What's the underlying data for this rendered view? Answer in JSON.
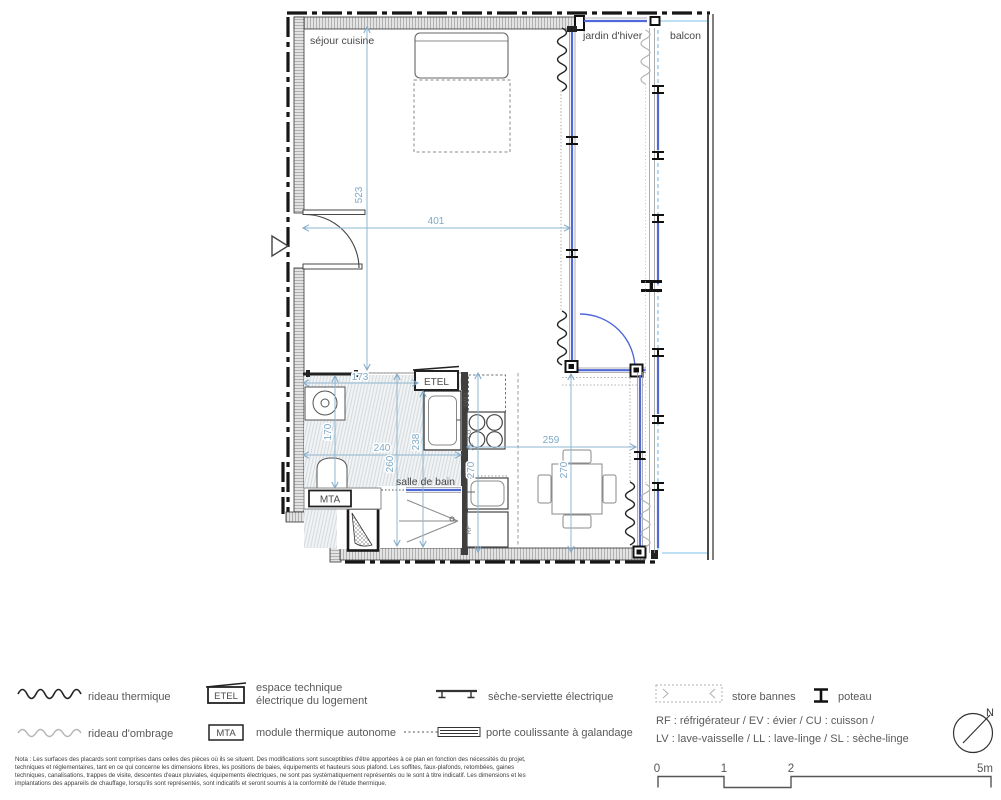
{
  "plan": {
    "rooms": {
      "sejour_cuisine": "séjour cuisine",
      "jardin_hiver": "jardin d'hiver",
      "balcon": "balcon",
      "salle_de_bain": "salle de bain"
    },
    "boxes": {
      "etel": "ETEL",
      "mta": "MTA"
    },
    "appliances": {
      "lv_ll": "LV/LL",
      "cu": "CU",
      "ev": "EV",
      "rf": "RF"
    },
    "dims": {
      "sejour_height": "523",
      "sejour_width": "401",
      "bain_top": "173",
      "bain_left": "170",
      "bain_width": "240",
      "bain_height": "260",
      "kitchen_wall": "238",
      "kitchen_depth": "270",
      "dining_width": "259",
      "dining_depth": "270"
    }
  },
  "legend": {
    "rideau_thermique": "rideau thermique",
    "rideau_ombrage": "rideau d'ombrage",
    "etel_box": "ETEL",
    "etel_line1": "espace technique",
    "etel_line2": "électrique du logement",
    "mta_box": "MTA",
    "mta_label": "module thermique autonome",
    "seche_serviette": "sèche-serviette électrique",
    "porte_coulissante": "porte coulissante à galandage",
    "store_bannes": "store bannes",
    "poteau": "poteau",
    "abbr_line1": "RF : réfrigérateur / EV : évier / CU : cuisson /",
    "abbr_line2": "LV : lave-vaisselle / LL : lave-linge / SL : sèche-linge"
  },
  "scale_bar": {
    "t0": "0",
    "t1": "1",
    "t2": "2",
    "t5": "5m"
  },
  "north_label": "N",
  "nota": {
    "lines": [
      "Nota : Les surfaces des placards sont comprises dans celles des pièces où ils se situent. Des modifications sont susceptibles d'être apportées à ce plan en fonction des nécessités du projet,",
      "techniques et réglementaires, tant en ce qui concerne les dimensions libres, les positions de baies, équipements et hauteurs sous plafond. Les soffites, faux-plafonds, retombées, gaines",
      "techniques, canalisations, trappes de visite, descentes d'eaux pluviales, équipements électriques, ne sont pas systématiquement représentés ou le sont à titre indicatif. Les dimensions et les",
      "implantations des appareils de chauffage, lorsqu'ils sont représentés, sont indicatifs et seront soumis à la conformité de l'étude thermique."
    ]
  },
  "colors": {
    "glass_blue": "#5069d6",
    "light_blue": "#a9d6f0",
    "dim_blue": "#84aac6",
    "wall_dark": "#1a1a1a"
  }
}
